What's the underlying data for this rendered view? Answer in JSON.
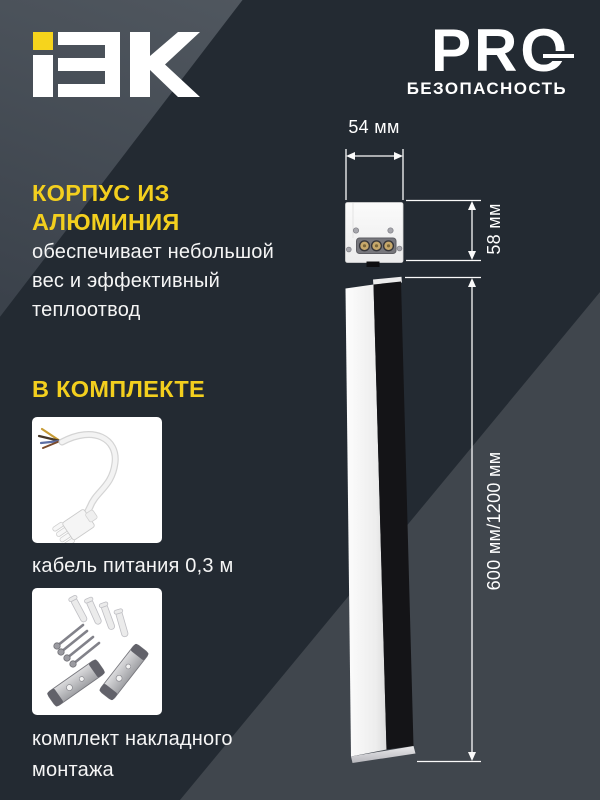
{
  "header": {
    "logo": {
      "text": "IEK",
      "dot_color": "#F6D41C"
    },
    "pro_badge": {
      "title": "PRO",
      "subtitle": "БЕЗОПАСНОСТЬ"
    }
  },
  "feature": {
    "heading": "КОРПУС ИЗ АЛЮМИНИЯ",
    "description": "обеспечивает небольшой вес и эффективный теплоотвод"
  },
  "kit": {
    "heading": "В КОМПЛЕКТЕ",
    "items": [
      {
        "image": "power-cable-photo",
        "caption": "кабель питания 0,3 м"
      },
      {
        "image": "mounting-kit-photo",
        "caption": "комплект накладного монтажа"
      }
    ]
  },
  "dimensions": {
    "width": "54 мм",
    "height": "58 мм",
    "length": "600 мм/1200 мм"
  },
  "colors": {
    "background": "#232A32",
    "triangle_top_left": "#49505A",
    "triangle_bottom_right": "#40464D",
    "accent_yellow": "#F3CF1E",
    "text_white": "#FFFFFF",
    "luminaire_black": "#141417",
    "luminaire_diffuser": "#F5F5F5",
    "terminal_brass": "#C6A86B"
  }
}
